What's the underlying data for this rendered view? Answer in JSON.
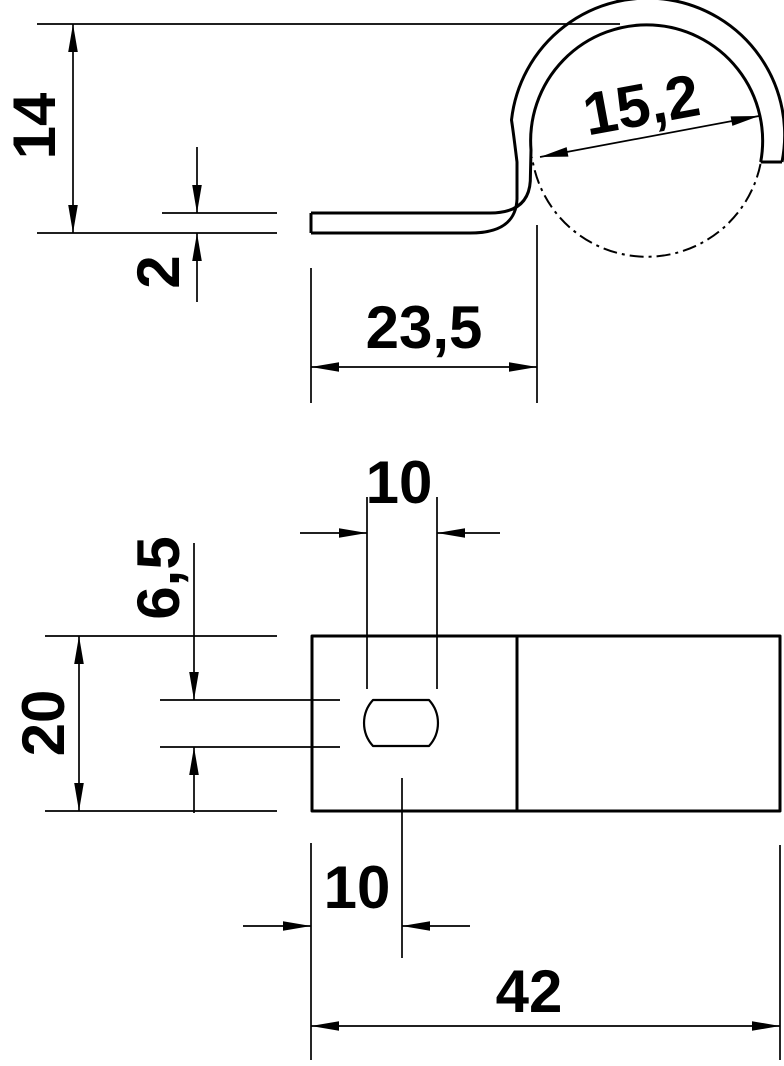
{
  "drawing": {
    "background_color": "#ffffff",
    "line_color": "#000000",
    "views": {
      "side_view": {
        "dimensions": {
          "loop_height": "14",
          "material_thickness": "2",
          "leg_length": "23,5",
          "clamp_inner_diameter": "15,2"
        }
      },
      "plan_view": {
        "dimensions": {
          "slot_length": "10",
          "slot_width": "6,5",
          "plate_width": "20",
          "slot_center_offset": "10",
          "plate_length": "42"
        }
      }
    }
  }
}
